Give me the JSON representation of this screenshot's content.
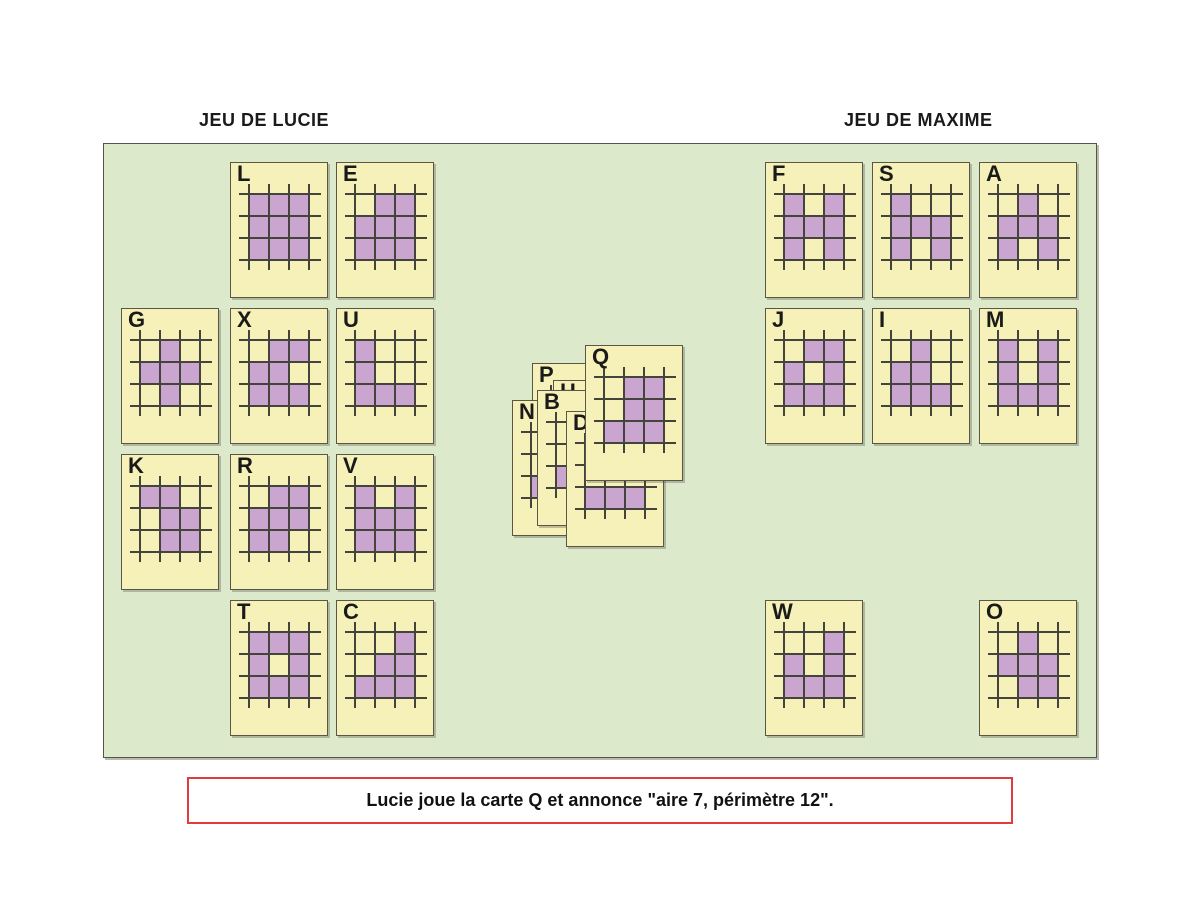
{
  "titles": {
    "left": "JEU DE LUCIE",
    "right": "JEU DE MAXIME"
  },
  "announcement": {
    "text": "Lucie joue la carte Q et annonce \"aire 7, périmètre 12\"."
  },
  "colors": {
    "board_bg": "#dde9cb",
    "card_bg": "#f6f1b8",
    "cell_fill": "#c9a5cf",
    "grid_line": "#45443c",
    "announcement_border": "#e03c3c"
  },
  "cards": {
    "lucie": [
      {
        "letter": "L",
        "x": 230,
        "y": 162,
        "grid": [
          [
            1,
            1,
            1
          ],
          [
            1,
            1,
            1
          ],
          [
            1,
            1,
            1
          ]
        ]
      },
      {
        "letter": "E",
        "x": 336,
        "y": 162,
        "grid": [
          [
            0,
            1,
            1
          ],
          [
            1,
            1,
            1
          ],
          [
            1,
            1,
            1
          ]
        ]
      },
      {
        "letter": "G",
        "x": 121,
        "y": 308,
        "grid": [
          [
            0,
            1,
            0
          ],
          [
            1,
            1,
            1
          ],
          [
            0,
            1,
            0
          ]
        ]
      },
      {
        "letter": "X",
        "x": 230,
        "y": 308,
        "grid": [
          [
            0,
            1,
            1
          ],
          [
            1,
            1,
            0
          ],
          [
            1,
            1,
            1
          ]
        ]
      },
      {
        "letter": "U",
        "x": 336,
        "y": 308,
        "grid": [
          [
            1,
            0,
            0
          ],
          [
            1,
            0,
            0
          ],
          [
            1,
            1,
            1
          ]
        ]
      },
      {
        "letter": "K",
        "x": 121,
        "y": 454,
        "grid": [
          [
            1,
            1,
            0
          ],
          [
            0,
            1,
            1
          ],
          [
            0,
            1,
            1
          ]
        ]
      },
      {
        "letter": "R",
        "x": 230,
        "y": 454,
        "grid": [
          [
            0,
            1,
            1
          ],
          [
            1,
            1,
            1
          ],
          [
            1,
            1,
            0
          ]
        ]
      },
      {
        "letter": "V",
        "x": 336,
        "y": 454,
        "grid": [
          [
            1,
            0,
            1
          ],
          [
            1,
            1,
            1
          ],
          [
            1,
            1,
            1
          ]
        ]
      },
      {
        "letter": "T",
        "x": 230,
        "y": 600,
        "grid": [
          [
            1,
            1,
            1
          ],
          [
            1,
            0,
            1
          ],
          [
            1,
            1,
            1
          ]
        ]
      },
      {
        "letter": "C",
        "x": 336,
        "y": 600,
        "grid": [
          [
            0,
            0,
            1
          ],
          [
            0,
            1,
            1
          ],
          [
            1,
            1,
            1
          ]
        ]
      }
    ],
    "maxime": [
      {
        "letter": "F",
        "x": 765,
        "y": 162,
        "grid": [
          [
            1,
            0,
            1
          ],
          [
            1,
            1,
            1
          ],
          [
            1,
            0,
            1
          ]
        ]
      },
      {
        "letter": "S",
        "x": 872,
        "y": 162,
        "grid": [
          [
            1,
            0,
            0
          ],
          [
            1,
            1,
            1
          ],
          [
            1,
            0,
            1
          ]
        ]
      },
      {
        "letter": "A",
        "x": 979,
        "y": 162,
        "grid": [
          [
            0,
            1,
            0
          ],
          [
            1,
            1,
            1
          ],
          [
            1,
            0,
            1
          ]
        ]
      },
      {
        "letter": "J",
        "x": 765,
        "y": 308,
        "grid": [
          [
            0,
            1,
            1
          ],
          [
            1,
            0,
            1
          ],
          [
            1,
            1,
            1
          ]
        ]
      },
      {
        "letter": "I",
        "x": 872,
        "y": 308,
        "grid": [
          [
            0,
            1,
            0
          ],
          [
            1,
            1,
            0
          ],
          [
            1,
            1,
            1
          ]
        ]
      },
      {
        "letter": "M",
        "x": 979,
        "y": 308,
        "grid": [
          [
            1,
            0,
            1
          ],
          [
            1,
            0,
            1
          ],
          [
            1,
            1,
            1
          ]
        ]
      },
      {
        "letter": "W",
        "x": 765,
        "y": 600,
        "grid": [
          [
            0,
            0,
            1
          ],
          [
            1,
            0,
            1
          ],
          [
            1,
            1,
            1
          ]
        ]
      },
      {
        "letter": "O",
        "x": 979,
        "y": 600,
        "grid": [
          [
            0,
            1,
            0
          ],
          [
            1,
            1,
            1
          ],
          [
            0,
            1,
            1
          ]
        ]
      }
    ],
    "pile": [
      {
        "letter": "P",
        "x": 532,
        "y": 363,
        "z": 1,
        "grid": [
          [
            0,
            0,
            0
          ],
          [
            0,
            0,
            0
          ],
          [
            0,
            0,
            0
          ]
        ]
      },
      {
        "letter": "H",
        "x": 553,
        "y": 380,
        "z": 2,
        "grid": [
          [
            0,
            0,
            0
          ],
          [
            0,
            0,
            0
          ],
          [
            0,
            0,
            0
          ]
        ]
      },
      {
        "letter": "N",
        "x": 512,
        "y": 400,
        "z": 3,
        "grid": [
          [
            0,
            0,
            0
          ],
          [
            0,
            0,
            0
          ],
          [
            1,
            0,
            0
          ]
        ]
      },
      {
        "letter": "B",
        "x": 537,
        "y": 390,
        "z": 4,
        "grid": [
          [
            0,
            0,
            0
          ],
          [
            0,
            0,
            0
          ],
          [
            1,
            0,
            0
          ]
        ]
      },
      {
        "letter": "D",
        "x": 566,
        "y": 411,
        "z": 5,
        "grid": [
          [
            0,
            0,
            0
          ],
          [
            0,
            0,
            0
          ],
          [
            1,
            1,
            1
          ]
        ]
      },
      {
        "letter": "Q",
        "x": 585,
        "y": 345,
        "z": 6,
        "grid": [
          [
            0,
            1,
            1
          ],
          [
            0,
            1,
            1
          ],
          [
            1,
            1,
            1
          ]
        ]
      }
    ]
  }
}
